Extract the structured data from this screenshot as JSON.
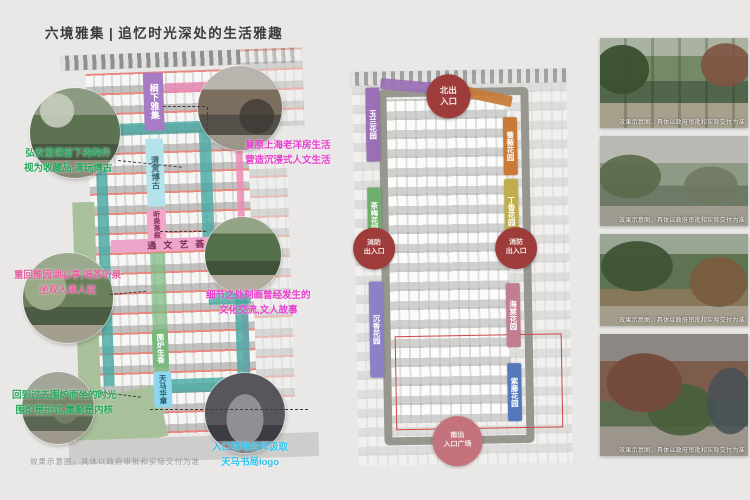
{
  "header": {
    "title": "六境雅集",
    "separator": "|",
    "subtitle": "追忆时光深处的生活雅趣"
  },
  "colors": {
    "accent_magenta": "#e83ccf",
    "accent_green": "#27a65c",
    "accent_pink": "#e85f9f",
    "accent_cyan": "#2fc4ec",
    "zone_purple": "#a87cc4",
    "zone_lightcyan": "#b5e3ec",
    "zone_pink": "#f2a6ca",
    "zone_band_pink": "#eda6c9",
    "zone_green": "#79b97d",
    "zone_skyblue": "#8ed7ee",
    "path_teal": "#49a8a2",
    "path_pink": "#ec8ab5",
    "entrance_red": "#9e3c3c",
    "entrance_pink": "#c4737d",
    "garden_purple": "#9b6fb5",
    "garden_green": "#6fae6c",
    "garden_violet": "#8b82c6",
    "garden_orange": "#c87a36",
    "garden_yellow": "#c0ae4a",
    "garden_rose": "#c27d92",
    "garden_blue": "#5577bb"
  },
  "left_plan": {
    "zone_labels": {
      "lin_xia": "榈下雅集",
      "qing_shang": "清赏博古",
      "ting_quan": "听泉茶叙",
      "tong_wen": "通文艺荟",
      "wei_lu": "围炉生香",
      "tian_ma": "天马华章"
    },
    "annotations": {
      "heritage": {
        "line1": "弘安里保留下的构件",
        "line2": "视为收藏品,清玩博古"
      },
      "shanghai": {
        "line1": "复原上海老洋房生活",
        "line2": "营造沉浸式人文生活"
      },
      "teahouse": {
        "line1": "重回豫园湖心亭,喝茶听泉",
        "line2": "坐观人来人往"
      },
      "culture": {
        "line1": "细节之处刻画曾经发生的",
        "line2": "文化交流,文人故事"
      },
      "fireside": {
        "line1": "回到过去围炉而坐的时光",
        "line2": "围炉是形式,集聚是内核"
      },
      "paving": {
        "line1": "入口铺地纹样汲取",
        "line2": "天马书局logo"
      }
    },
    "disclaimer": "效果示意图，具体以政府审批和实际交付为准"
  },
  "middle_plan": {
    "entrances": {
      "north": {
        "line1": "北出",
        "line2": "入口"
      },
      "fire_left": {
        "line1": "消防",
        "line2": "出入口"
      },
      "fire_right": {
        "line1": "消防",
        "line2": "出入口"
      },
      "south": {
        "line1": "南出",
        "line2": "入口广场"
      }
    },
    "gardens": {
      "yulan": "玉兰花园",
      "chamei": "茶梅花园",
      "chenxiang": "沉香花园",
      "qiangwei": "蔷薇花园",
      "dingxiang": "丁香花园",
      "haitang": "海棠花园",
      "ziteng": "紫藤花园"
    }
  },
  "photos": [
    {
      "caption": "效果示意图，具体以政府审批和实际交付为准"
    },
    {
      "caption": "效果示意图，具体以政府审批和实际交付为准"
    },
    {
      "caption": "效果示意图，具体以政府审批和实际交付为准"
    },
    {
      "caption": "效果示意图，具体以政府审批和实际交付为准"
    }
  ]
}
